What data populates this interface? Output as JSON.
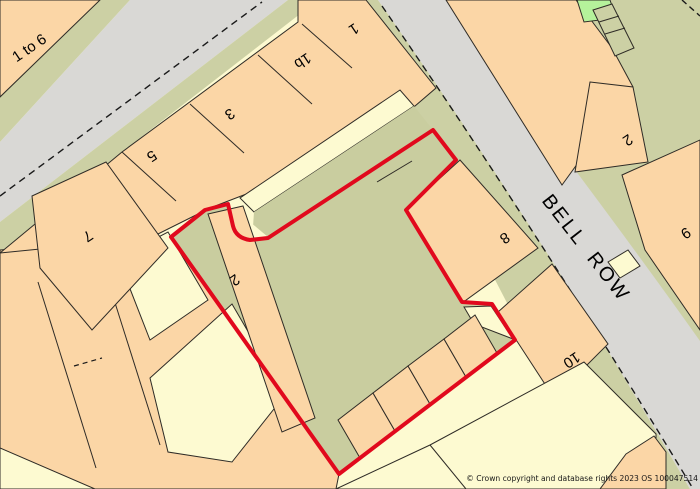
{
  "map": {
    "street_label": "BELL ROW",
    "labels": [
      {
        "text": "1 to 6"
      },
      {
        "text": "5"
      },
      {
        "text": "3"
      },
      {
        "text": "1b"
      },
      {
        "text": "1"
      },
      {
        "text": "7"
      },
      {
        "text": "2"
      },
      {
        "text": "8"
      },
      {
        "text": "10"
      },
      {
        "text": "2"
      },
      {
        "text": "9"
      }
    ],
    "copyright": "© Crown copyright and database rights 2023 OS 100047514",
    "colors": {
      "background_cream": "#FDFAD1",
      "building_peach": "#FBD6A6",
      "road_gray": "#D9D8D5",
      "verge_khaki": "#CCD0A4",
      "bright_green": "#B5F29B",
      "boundary_red": "#E1091D",
      "outline": "#2E2B26"
    }
  }
}
